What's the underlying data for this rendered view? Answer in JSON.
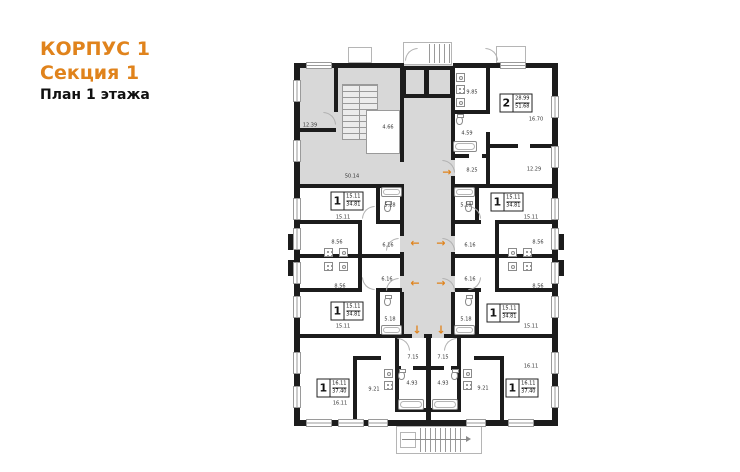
{
  "header": {
    "building": "КОРПУС 1",
    "section": "Секция 1",
    "floor_label": "План 1 этажа"
  },
  "colors": {
    "accent": "#e0831c",
    "wall": "#1c1c1c",
    "common_fill": "#d8d8d8",
    "line": "#9a9a9a"
  },
  "plan": {
    "room_labels": [
      {
        "text": "12.39",
        "x": 310,
        "y": 126
      },
      {
        "text": "4.66",
        "x": 388,
        "y": 128
      },
      {
        "text": "50.14",
        "x": 352,
        "y": 177
      },
      {
        "text": "9.85",
        "x": 472,
        "y": 93
      },
      {
        "text": "4.59",
        "x": 467,
        "y": 134
      },
      {
        "text": "8.25",
        "x": 472,
        "y": 171
      },
      {
        "text": "16.70",
        "x": 536,
        "y": 120
      },
      {
        "text": "12.29",
        "x": 534,
        "y": 170
      },
      {
        "text": "15.11",
        "x": 343,
        "y": 218
      },
      {
        "text": "5.18",
        "x": 390,
        "y": 206
      },
      {
        "text": "8.56",
        "x": 337,
        "y": 243
      },
      {
        "text": "6.16",
        "x": 388,
        "y": 246
      },
      {
        "text": "8.56",
        "x": 340,
        "y": 287
      },
      {
        "text": "6.16",
        "x": 387,
        "y": 280
      },
      {
        "text": "15.11",
        "x": 343,
        "y": 327
      },
      {
        "text": "5.18",
        "x": 390,
        "y": 320
      },
      {
        "text": "5.18",
        "x": 466,
        "y": 206
      },
      {
        "text": "15.11",
        "x": 531,
        "y": 218
      },
      {
        "text": "6.16",
        "x": 470,
        "y": 246
      },
      {
        "text": "8.56",
        "x": 538,
        "y": 243
      },
      {
        "text": "6.16",
        "x": 470,
        "y": 280
      },
      {
        "text": "8.56",
        "x": 538,
        "y": 287
      },
      {
        "text": "5.18",
        "x": 466,
        "y": 320
      },
      {
        "text": "15.11",
        "x": 531,
        "y": 327
      },
      {
        "text": "16.11",
        "x": 340,
        "y": 404
      },
      {
        "text": "9.21",
        "x": 374,
        "y": 390
      },
      {
        "text": "7.15",
        "x": 413,
        "y": 358
      },
      {
        "text": "4.93",
        "x": 412,
        "y": 384
      },
      {
        "text": "7.15",
        "x": 443,
        "y": 358
      },
      {
        "text": "4.93",
        "x": 443,
        "y": 384
      },
      {
        "text": "9.21",
        "x": 483,
        "y": 389
      },
      {
        "text": "16.11",
        "x": 531,
        "y": 367
      }
    ],
    "apartment_tags": [
      {
        "rooms": "2",
        "living_area": "28.99",
        "total_area": "51.68",
        "x": 516,
        "y": 103
      },
      {
        "rooms": "1",
        "living_area": "15.11",
        "total_area": "34.81",
        "x": 347,
        "y": 201
      },
      {
        "rooms": "1",
        "living_area": "15.11",
        "total_area": "34.81",
        "x": 507,
        "y": 202
      },
      {
        "rooms": "1",
        "living_area": "15.11",
        "total_area": "34.81",
        "x": 347,
        "y": 311
      },
      {
        "rooms": "1",
        "living_area": "15.11",
        "total_area": "34.81",
        "x": 503,
        "y": 313
      },
      {
        "rooms": "1",
        "living_area": "16.11",
        "total_area": "37.40",
        "x": 333,
        "y": 388
      },
      {
        "rooms": "1",
        "living_area": "16.11",
        "total_area": "37.40",
        "x": 522,
        "y": 388
      }
    ],
    "entrance_arrows": [
      {
        "dir": "right",
        "x": 447,
        "y": 172
      },
      {
        "dir": "left",
        "x": 415,
        "y": 243
      },
      {
        "dir": "right",
        "x": 441,
        "y": 243
      },
      {
        "dir": "left",
        "x": 415,
        "y": 283
      },
      {
        "dir": "right",
        "x": 441,
        "y": 283
      },
      {
        "dir": "down",
        "x": 417,
        "y": 330
      },
      {
        "dir": "down",
        "x": 441,
        "y": 330
      }
    ]
  }
}
